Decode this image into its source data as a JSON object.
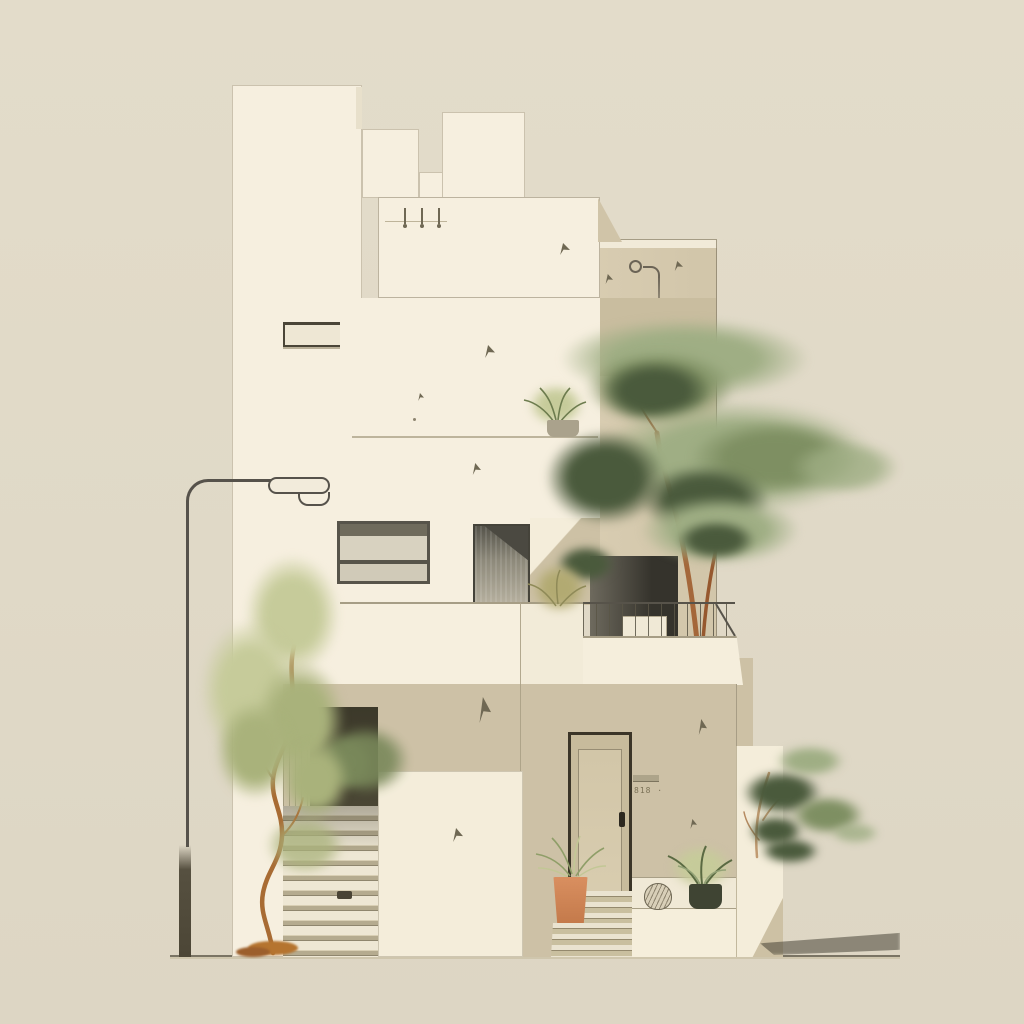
{
  "illustration": {
    "title": "Minimalist modern stepped house with trees",
    "style": "flat architectural illustration on beige background",
    "house_number": "818 ·"
  },
  "palette": {
    "background": "#e0d9c7",
    "wall_cream": "#f6efdf",
    "wall_tan": "#cdc1a6",
    "under_slab_shadow": "#c9bd9f",
    "dark_opening": "#3e3a2b",
    "glass_gray": "#8d897a",
    "foliage_light_sage": "#9fae84",
    "foliage_dark_green": "#4a5a3c",
    "foliage_yellow_green": "#c6cb9a",
    "trunk_orange": "#a86b33",
    "terracotta_pot": "#d28a5c",
    "line_dark": "#56524b",
    "ground_line": "#7a7464"
  },
  "scene": {
    "objects": [
      "street-lamp",
      "left-tree",
      "stepped-tower",
      "tower-window-slot",
      "upper-balcony-slab",
      "parapet-vents",
      "drain-pipe",
      "picture-window",
      "glass-door",
      "balcony-railing",
      "balcony-planter-box",
      "big-tree",
      "entry-door",
      "house-number-plaque",
      "side-staircase",
      "slatted-screen",
      "garage-opening",
      "white-panel",
      "entry-steps",
      "terracotta-pot-plant",
      "woven-basket",
      "ledge-fern",
      "right-planter-tree",
      "ground-shadow"
    ]
  }
}
